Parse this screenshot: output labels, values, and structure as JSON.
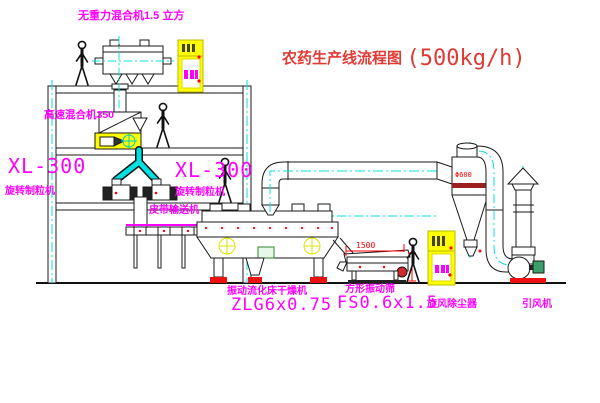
{
  "diagram": {
    "title": "农药生产线流程图",
    "capacity": "(500kg/h)",
    "labels": {
      "gravity_mixer": "无重力混合机1.5 立方",
      "high_speed_mixer": "高速混合机350",
      "granulator_model_left": "XL-300",
      "granulator_name_left": "旋转制粒机",
      "granulator_model_right": "XL-300",
      "granulator_name_right": "旋转制粒机",
      "belt_conveyor": "皮带输送机",
      "dryer_name": "振动流化床干燥机",
      "dryer_model": "ZLG6x0.75",
      "screen_name": "方形振动筛",
      "screen_model": "FS0.6x1.5",
      "cyclone": "旋风除尘器",
      "fan": "引风机"
    },
    "dimensions": {
      "screen_length": "1500",
      "cyclone_diameter": "Φ600"
    },
    "colors": {
      "label_magenta": "#ff00ff",
      "title_red": "#e03a35",
      "pipe_cyan": "#00e0e0",
      "cabinet_yellow": "#ffff00",
      "accent_red": "#ff0000",
      "line_black": "#1a1a1a"
    }
  }
}
